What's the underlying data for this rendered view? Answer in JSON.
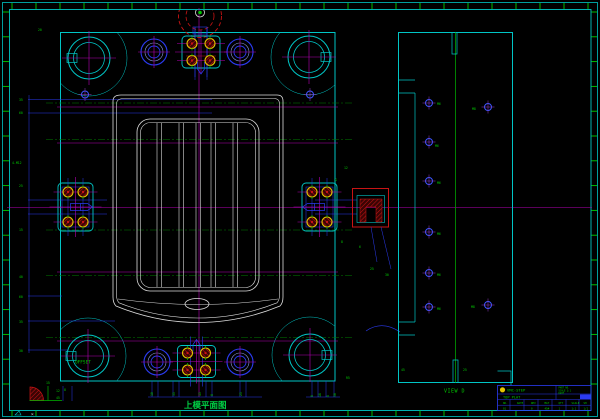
{
  "labels": {
    "plan_caption": "上模平面图",
    "side_caption": "VIEW D",
    "offset_marking": "OFFSET",
    "ucs_mark": "✕"
  },
  "title_block": {
    "logo_text": "VMC-STEP",
    "part_name": "TOP PLAT",
    "info_lines": [
      "PART NO.",
      "SCALE 1:1",
      "DATE"
    ],
    "grid_row1": [
      "NO.",
      "DATE",
      "REV",
      "MAT",
      "QTY",
      "SCALE",
      "SH"
    ],
    "grid_row2": [
      "01",
      "",
      "0",
      "45#",
      "1",
      "1:1",
      "1/1"
    ]
  },
  "colors": {
    "background": "#000000",
    "frame_cyan": "#00c5c5",
    "secondary_blue": "#2b3bf2",
    "centerline_magenta": "#b400b4",
    "annotation_green": "#00c800",
    "part_white": "#dcdcdc",
    "detail_red": "#c81414",
    "screw_yellow": "#e3c400"
  },
  "dimensions": {
    "left": [
      {
        "x": 19,
        "y": 101,
        "t": "35"
      },
      {
        "x": 19,
        "y": 114,
        "t": "60"
      },
      {
        "x": 12,
        "y": 164,
        "t": "4-M12"
      },
      {
        "x": 19,
        "y": 187,
        "t": "25"
      },
      {
        "x": 19,
        "y": 231,
        "t": "15"
      },
      {
        "x": 19,
        "y": 278,
        "t": "40"
      },
      {
        "x": 19,
        "y": 298,
        "t": "60"
      },
      {
        "x": 19,
        "y": 323,
        "t": "35"
      },
      {
        "x": 19,
        "y": 352,
        "t": "30"
      }
    ],
    "top": [
      {
        "x": 38,
        "y": 31,
        "t": "20"
      }
    ],
    "bottom": [
      {
        "x": 153,
        "y": 396,
        "t": "10"
      },
      {
        "x": 175,
        "y": 396,
        "t": "35"
      },
      {
        "x": 201,
        "y": 396,
        "t": "15"
      },
      {
        "x": 213,
        "y": 396,
        "t": "8"
      },
      {
        "x": 242,
        "y": 396,
        "t": "25"
      },
      {
        "x": 313,
        "y": 397,
        "t": "6"
      },
      {
        "x": 321,
        "y": 397,
        "t": "18"
      },
      {
        "x": 329,
        "y": 397,
        "t": "6"
      },
      {
        "x": 336,
        "y": 397,
        "t": "30"
      }
    ],
    "bottom_left": [
      {
        "x": 56,
        "y": 392,
        "t": "12"
      },
      {
        "x": 56,
        "y": 399,
        "t": "45"
      },
      {
        "x": 46,
        "y": 384,
        "t": "15"
      },
      {
        "x": 64,
        "y": 391,
        "t": "8"
      }
    ],
    "plan_extra": [
      {
        "x": 344,
        "y": 169,
        "t": "12"
      },
      {
        "x": 335,
        "y": 181,
        "t": "G"
      },
      {
        "x": 341,
        "y": 243,
        "t": "8"
      },
      {
        "x": 359,
        "y": 248,
        "t": "6"
      },
      {
        "x": 370,
        "y": 270,
        "t": "25"
      },
      {
        "x": 385,
        "y": 276,
        "t": "30"
      },
      {
        "x": 346,
        "y": 379,
        "t": "R5"
      }
    ],
    "side_view": [
      {
        "x": 437,
        "y": 105,
        "t": "M6"
      },
      {
        "x": 435,
        "y": 147,
        "t": "M6"
      },
      {
        "x": 437,
        "y": 184,
        "t": "M6"
      },
      {
        "x": 437,
        "y": 235,
        "t": "M6"
      },
      {
        "x": 437,
        "y": 276,
        "t": "M6"
      },
      {
        "x": 437,
        "y": 310,
        "t": "M6"
      },
      {
        "x": 472,
        "y": 110,
        "t": "M8"
      },
      {
        "x": 471,
        "y": 308,
        "t": "M8"
      },
      {
        "x": 401,
        "y": 371,
        "t": "45"
      },
      {
        "x": 463,
        "y": 371,
        "t": "25"
      }
    ]
  }
}
